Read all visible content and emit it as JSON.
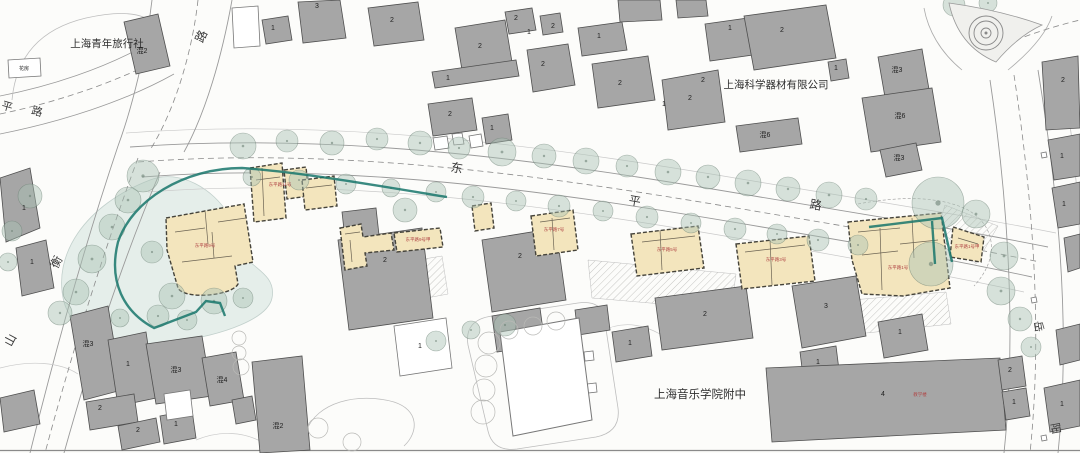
{
  "colors": {
    "background": "#fcfcfa",
    "building_gray": "#a6a6a6",
    "building_gray_stroke": "#4f4f4f",
    "building_white": "#ffffff",
    "heritage_yellow": "#f3e5bd",
    "heritage_stroke": "#45433a",
    "tree_fill": "rgba(168,193,180,0.45)",
    "tree_stroke": "rgba(100,122,110,0.55)",
    "boundary_teal": "#17766b",
    "red_label": "#b04545",
    "road_line": "#9a9a9a",
    "faint_line": "#c4c4c4",
    "garden_tint": "rgba(205,224,218,0.5)"
  },
  "landmark_labels": [
    {
      "t": "上海青年旅行社",
      "x": 107,
      "y": 47,
      "s": 10.5
    },
    {
      "t": "上海科学器材有限公司",
      "x": 776,
      "y": 88,
      "s": 10.5
    },
    {
      "t": "上海音乐学院附中",
      "x": 700,
      "y": 398,
      "s": 11.5
    }
  ],
  "road_name_chars": [
    {
      "t": "东",
      "x": 456,
      "y": 172,
      "s": 12,
      "r": 10
    },
    {
      "t": "平",
      "x": 634,
      "y": 205,
      "s": 12,
      "r": 10
    },
    {
      "t": "路",
      "x": 815,
      "y": 209,
      "s": 12,
      "r": 10
    },
    {
      "t": "衡",
      "x": 60,
      "y": 264,
      "s": 12,
      "r": -62
    },
    {
      "t": "山",
      "x": 14,
      "y": 342,
      "s": 12,
      "r": -62
    },
    {
      "t": "路",
      "x": 205,
      "y": 38,
      "s": 12,
      "r": -65
    },
    {
      "t": "平",
      "x": 6,
      "y": 110,
      "s": 11,
      "r": 16
    },
    {
      "t": "路",
      "x": 36,
      "y": 115,
      "s": 11,
      "r": 16
    },
    {
      "t": "岳",
      "x": 1035,
      "y": 327,
      "s": 11,
      "r": 80
    },
    {
      "t": "阳",
      "x": 1052,
      "y": 429,
      "s": 11,
      "r": 80
    }
  ],
  "building_numbers": [
    {
      "t": "混2",
      "x": 142,
      "y": 53
    },
    {
      "t": "3",
      "x": 317,
      "y": 8
    },
    {
      "t": "1",
      "x": 273,
      "y": 30
    },
    {
      "t": "2",
      "x": 392,
      "y": 22
    },
    {
      "t": "2",
      "x": 480,
      "y": 48
    },
    {
      "t": "2",
      "x": 516,
      "y": 20
    },
    {
      "t": "1",
      "x": 529,
      "y": 34
    },
    {
      "t": "2",
      "x": 543,
      "y": 66
    },
    {
      "t": "1",
      "x": 448,
      "y": 80
    },
    {
      "t": "1",
      "x": 599,
      "y": 38
    },
    {
      "t": "2",
      "x": 620,
      "y": 85
    },
    {
      "t": "2",
      "x": 690,
      "y": 100
    },
    {
      "t": "1",
      "x": 730,
      "y": 30
    },
    {
      "t": "2",
      "x": 782,
      "y": 32
    },
    {
      "t": "1",
      "x": 836,
      "y": 70
    },
    {
      "t": "混3",
      "x": 897,
      "y": 72
    },
    {
      "t": "混6",
      "x": 900,
      "y": 118
    },
    {
      "t": "混6",
      "x": 765,
      "y": 137
    },
    {
      "t": "混3",
      "x": 899,
      "y": 160
    },
    {
      "t": "2",
      "x": 1063,
      "y": 82
    },
    {
      "t": "1",
      "x": 1062,
      "y": 158
    },
    {
      "t": "1",
      "x": 1064,
      "y": 206
    },
    {
      "t": "1",
      "x": 1062,
      "y": 406
    },
    {
      "t": "2",
      "x": 385,
      "y": 262
    },
    {
      "t": "2",
      "x": 450,
      "y": 116
    },
    {
      "t": "1",
      "x": 492,
      "y": 130
    },
    {
      "t": "2",
      "x": 520,
      "y": 258
    },
    {
      "t": "1",
      "x": 420,
      "y": 348
    },
    {
      "t": "2",
      "x": 705,
      "y": 316
    },
    {
      "t": "1",
      "x": 630,
      "y": 345
    },
    {
      "t": "3",
      "x": 826,
      "y": 308
    },
    {
      "t": "1",
      "x": 818,
      "y": 364
    },
    {
      "t": "1",
      "x": 900,
      "y": 334
    },
    {
      "t": "4",
      "x": 883,
      "y": 396
    },
    {
      "t": "2",
      "x": 1010,
      "y": 372
    },
    {
      "t": "1",
      "x": 1014,
      "y": 404
    },
    {
      "t": "混3",
      "x": 88,
      "y": 346
    },
    {
      "t": "1",
      "x": 128,
      "y": 366
    },
    {
      "t": "混3",
      "x": 176,
      "y": 372
    },
    {
      "t": "混4",
      "x": 222,
      "y": 382
    },
    {
      "t": "2",
      "x": 100,
      "y": 410
    },
    {
      "t": "2",
      "x": 138,
      "y": 432
    },
    {
      "t": "1",
      "x": 176,
      "y": 426
    },
    {
      "t": "混2",
      "x": 278,
      "y": 428
    },
    {
      "t": "1",
      "x": 24,
      "y": 210
    },
    {
      "t": "1",
      "x": 32,
      "y": 264
    },
    {
      "t": "花房",
      "x": 24,
      "y": 70,
      "s": 5
    },
    {
      "t": "2",
      "x": 703,
      "y": 82
    },
    {
      "t": "1",
      "x": 664,
      "y": 106
    },
    {
      "t": "2",
      "x": 553,
      "y": 28
    }
  ],
  "red_labels": [
    {
      "t": "东平路11号",
      "x": 280,
      "y": 186
    },
    {
      "t": "东平路9号",
      "x": 205,
      "y": 247
    },
    {
      "t": "东平路9号甲",
      "x": 418,
      "y": 241
    },
    {
      "t": "东平路7号",
      "x": 554,
      "y": 231
    },
    {
      "t": "东平路5号",
      "x": 667,
      "y": 251
    },
    {
      "t": "东平路3号",
      "x": 776,
      "y": 261
    },
    {
      "t": "东平路1号",
      "x": 898,
      "y": 269
    },
    {
      "t": "东平路1号甲",
      "x": 967,
      "y": 248
    },
    {
      "t": "教学楼",
      "x": 920,
      "y": 396
    }
  ],
  "garden_tints": [
    {
      "d": "M150,180 C85,205 52,255 64,302 C74,338 122,350 172,342 C226,335 268,318 272,298 C276,278 258,270 248,260 C238,248 236,228 228,214 C214,190 180,168 150,180 Z"
    }
  ],
  "site_lines": [
    {
      "d": "M130,147 C350,131 560,163 760,197 C880,217 968,231 1048,247",
      "c": "#9a9a9a",
      "w": 0.9
    },
    {
      "d": "M142,177 C350,161 562,193 762,227 C882,247 958,261 1032,277",
      "c": "#9a9a9a",
      "w": 0.9
    },
    {
      "d": "M126,133 C350,117 565,149 765,183 C885,203 975,217 1056,233",
      "c": "#c9c9c9",
      "w": 0.7
    },
    {
      "d": "M148,192 C352,176 564,208 760,242 C875,262 950,276 1024,292",
      "c": "#c9c9c9",
      "w": 0.7
    },
    {
      "d": "M152,0 C146,52 132,108 118,146",
      "c": "#9a9a9a",
      "w": 0.9
    },
    {
      "d": "M232,0 C222,56 206,112 184,152",
      "c": "#9a9a9a",
      "w": 0.9
    },
    {
      "d": "M118,146 C88,235 58,340 30,453",
      "c": "#9a9a9a",
      "w": 0.9
    },
    {
      "d": "M160,172 C122,262 90,360 64,453",
      "c": "#9a9a9a",
      "w": 0.9
    },
    {
      "d": "M0,96 C52,86 104,68 144,46",
      "c": "#9a9a9a",
      "w": 0.8
    },
    {
      "d": "M0,134 C60,122 124,102 174,74",
      "c": "#9a9a9a",
      "w": 0.8
    },
    {
      "d": "M990,80 C1005,180 1018,320 1004,453",
      "c": "#9a9a9a",
      "w": 0.9
    },
    {
      "d": "M1038,70 C1056,180 1072,320 1058,453",
      "c": "#9a9a9a",
      "w": 0.9
    },
    {
      "d": "M1062,66 C1076,160 1080,220 1080,260",
      "c": "#bdbdbd",
      "w": 0.7
    },
    {
      "d": "M12,100 Q18,34 86,18 Q140,6 156,26",
      "c": "#bdbdbd",
      "w": 0.8
    },
    {
      "d": "M468,345 Q464,320 492,316 L578,303 Q600,300 604,316 L618,408 Q621,432 596,437 L517,449 Q493,452 488,431 Z",
      "c": "#bdbdbd",
      "w": 0.8
    },
    {
      "d": "M306,432 C316,402 358,392 394,402 C419,410 419,432 404,446",
      "c": "#bdbdbd",
      "w": 0.8
    },
    {
      "d": "M916,58 C898,95 896,130 912,160",
      "c": "#c9c9c9",
      "w": 0.7
    },
    {
      "d": "M600,332 C622,320 642,324 660,334",
      "c": "#c9c9c9",
      "w": 0.7
    },
    {
      "d": "M962,70 C940,52 928,30 924,8",
      "c": "#ababab",
      "w": 0.8
    },
    {
      "d": "M1008,70 C1030,52 1046,34 1052,16",
      "c": "#ababab",
      "w": 0.8
    },
    {
      "d": "M0,368 C30,360 60,362 78,374",
      "c": "#c9c9c9",
      "w": 0.7
    },
    {
      "d": "M196,440 C220,430 244,432 262,442",
      "c": "#c9c9c9",
      "w": 0.7
    },
    {
      "d": "M0,450.5 L1080,450.5",
      "c": "#8a8a8a",
      "w": 1.2
    }
  ],
  "dashed_lines": [
    {
      "d": "M138,162 C350,146 560,178 760,212 C880,232 962,246 1040,262",
      "c": "#8a8a8a",
      "w": 0.8,
      "p": "6,4"
    },
    {
      "d": "M138,158 C104,250 72,352 45,453",
      "c": "#8a8a8a",
      "w": 0.8,
      "p": "6,4"
    },
    {
      "d": "M198,0 C192,54 174,112 150,150",
      "c": "#8a8a8a",
      "w": 0.8,
      "p": "6,4"
    },
    {
      "d": "M0,114 C58,102 116,82 162,58",
      "c": "#8a8a8a",
      "w": 0.8,
      "p": "6,4"
    },
    {
      "d": "M1014,75 C1030,180 1044,320 1030,453",
      "c": "#8a8a8a",
      "w": 0.8,
      "p": "6,4"
    },
    {
      "d": "M1006,44 C1030,34 1055,26 1080,20",
      "c": "#8a8a8a",
      "w": 0.8,
      "p": "6,4"
    },
    {
      "d": "M858,204 C900,196 940,196 968,210 C996,226 1000,258 974,286",
      "c": "#9a9a9a",
      "w": 0.6,
      "p": "3,2"
    }
  ],
  "island": {
    "d": "M949,3 Q958,46 996,62 Q1018,36 1042,25 Q1000,10 949,3 Z"
  },
  "roundabout": {
    "cx": 986,
    "cy": 33,
    "radii": [
      17,
      12,
      5
    ]
  },
  "hatch_areas": [
    {
      "pts": "346,272 442,256 448,294 352,312"
    },
    {
      "pts": "588,260 736,274 731,310 592,298"
    },
    {
      "pts": "852,300 946,292 951,324 857,334"
    },
    {
      "pts": "945,205 998,226 976,264 938,228"
    }
  ],
  "gray_buildings": [
    {
      "pts": "124,22 158,14 170,66 136,74"
    },
    {
      "pts": "298,2 340,0 346,38 303,43"
    },
    {
      "pts": "262,20 288,16 292,40 266,44"
    },
    {
      "pts": "368,8 418,2 424,40 374,46"
    },
    {
      "pts": "455,28 505,20 512,62 462,70"
    },
    {
      "pts": "505,12 532,8 536,30 509,34"
    },
    {
      "pts": "540,16 560,13 563,32 543,35"
    },
    {
      "pts": "527,50 568,44 575,85 533,92"
    },
    {
      "pts": "432,72 516,60 519,76 435,88"
    },
    {
      "pts": "578,28 622,22 627,50 582,56"
    },
    {
      "pts": "592,64 648,56 655,100 598,108"
    },
    {
      "pts": "662,80 718,70 725,122 668,130"
    },
    {
      "pts": "705,24 755,17 760,54 710,61"
    },
    {
      "pts": "744,16 826,5 836,58 754,70"
    },
    {
      "pts": "828,62 846,59 849,78 831,81"
    },
    {
      "pts": "878,57 922,49 930,95 886,103"
    },
    {
      "pts": "862,98 932,88 941,142 871,152"
    },
    {
      "pts": "880,150 916,143 922,170 886,177"
    },
    {
      "pts": "736,126 798,118 802,144 740,152"
    },
    {
      "pts": "1042,62 1078,56 1080,128 1046,130"
    },
    {
      "pts": "1048,140 1080,134 1080,176 1054,180"
    },
    {
      "pts": "1052,188 1080,182 1080,224 1058,228"
    },
    {
      "pts": "1064,238 1080,234 1080,268 1068,272"
    },
    {
      "pts": "1044,388 1080,380 1080,426 1050,432"
    },
    {
      "pts": "1056,330 1080,324 1080,360 1060,365"
    },
    {
      "pts": "618,0 660,0 662,20 620,22"
    },
    {
      "pts": "676,0 706,0 708,16 678,18"
    },
    {
      "pts": "428,104 472,98 477,130 433,136"
    },
    {
      "pts": "482,118 508,114 512,140 486,144"
    },
    {
      "pts": "338,240 422,228 433,318 349,330"
    },
    {
      "pts": "482,240 556,228 566,300 492,312"
    },
    {
      "pts": "492,316 540,308 545,345 497,352"
    },
    {
      "pts": "575,310 607,305 610,330 578,335"
    },
    {
      "pts": "655,298 746,286 753,338 662,350"
    },
    {
      "pts": "612,332 648,326 652,356 616,362"
    },
    {
      "pts": "792,286 856,276 866,336 802,348"
    },
    {
      "pts": "800,352 836,346 840,378 804,384"
    },
    {
      "pts": "878,322 922,314 928,350 884,358"
    },
    {
      "pts": "766,368 1000,358 1006,430 772,442"
    },
    {
      "pts": "998,360 1022,356 1026,386 1002,390"
    },
    {
      "pts": "1002,392 1026,388 1030,416 1006,420"
    },
    {
      "pts": "70,316 108,306 122,390 84,400"
    },
    {
      "pts": "108,340 146,332 156,398 118,406"
    },
    {
      "pts": "146,344 202,336 212,396 156,404"
    },
    {
      "pts": "202,358 236,352 244,400 210,406"
    },
    {
      "pts": "86,402 134,394 138,422 90,430"
    },
    {
      "pts": "118,426 156,418 160,442 122,450"
    },
    {
      "pts": "160,416 192,410 196,438 164,444"
    },
    {
      "pts": "252,362 302,356 310,450 260,453"
    },
    {
      "pts": "232,400 252,396 256,420 236,424"
    },
    {
      "pts": "0,398 34,390 40,424 4,432"
    },
    {
      "pts": "0,178 30,168 40,228 6,242"
    },
    {
      "pts": "16,248 46,240 54,288 22,296"
    },
    {
      "pts": "342,212 376,208 380,244 346,248"
    }
  ],
  "white_buildings": [
    {
      "pts": "394,326 446,318 452,368 400,376"
    },
    {
      "pts": "8,60 40,58 41,76 9,78"
    },
    {
      "pts": "433,138 447,136 449,148 435,150"
    },
    {
      "pts": "452,134 462,133 464,144 454,145"
    },
    {
      "pts": "469,136 481,134 483,146 471,148"
    },
    {
      "pts": "584,352 593,351 594,360 585,361"
    },
    {
      "pts": "587,384 596,383 597,392 588,393"
    },
    {
      "pts": "1041,153 1046,152 1047,157 1042,158"
    },
    {
      "pts": "1031,298 1036,297 1037,302 1032,303"
    },
    {
      "pts": "1041,436 1046,435 1047,440 1042,441"
    },
    {
      "pts": "232,8 258,6 260,46 234,48"
    },
    {
      "pts": "164,394 190,390 193,416 167,420"
    }
  ],
  "field": {
    "pts": "500,332 579,318 592,420 513,436"
  },
  "yellow_buildings": [
    {
      "d": "M166,218 L244,204 L253,262 L235,266 L238,284 C232,296 184,300 178,288 L167,250 Z"
    },
    {
      "d": "M250,168 L282,163 L286,218 L254,222 Z"
    },
    {
      "d": "M284,170 L306,167 L309,196 L287,199 Z"
    },
    {
      "d": "M302,180 L334,176 L337,206 L305,210 Z"
    },
    {
      "d": "M340,228 L361,224 L363,237 L391,233 L394,250 L365,253 L367,266 L345,270 Z"
    },
    {
      "d": "M394,233 L440,228 L443,247 L397,252 Z"
    },
    {
      "d": "M472,206 L491,203 L494,228 L475,231 Z"
    },
    {
      "d": "M531,216 L573,210 L578,250 L536,256 Z"
    },
    {
      "d": "M631,234 L698,226 L704,268 L637,276 Z"
    },
    {
      "d": "M736,244 L809,236 L815,281 L742,289 Z"
    },
    {
      "d": "M848,222 L941,213 L950,288 L903,296 L862,294 L852,260 Z"
    },
    {
      "d": "M953,227 L984,237 L981,262 L950,257 Z"
    }
  ],
  "plan_lines": [
    {
      "d": "M175,232 L205,228"
    },
    {
      "d": "M205,210 L208,244"
    },
    {
      "d": "M218,222 L246,218"
    },
    {
      "d": "M182,262 L232,256"
    },
    {
      "d": "M212,232 L214,258"
    },
    {
      "d": "M256,180 L280,177"
    },
    {
      "d": "M262,168 L264,216"
    },
    {
      "d": "M306,188 L332,185"
    },
    {
      "d": "M345,234 L360,232"
    },
    {
      "d": "M350,240 L352,262"
    },
    {
      "d": "M540,222 L570,218"
    },
    {
      "d": "M552,218 L554,250"
    },
    {
      "d": "M642,242 L695,236"
    },
    {
      "d": "M660,230 L662,270"
    },
    {
      "d": "M745,252 L805,245"
    },
    {
      "d": "M770,240 L772,285"
    },
    {
      "d": "M858,232 L900,228"
    },
    {
      "d": "M880,228 L882,290"
    },
    {
      "d": "M900,244 L938,240"
    },
    {
      "d": "M912,218 L914,258"
    },
    {
      "d": "M862,255 L898,251"
    },
    {
      "d": "M958,238 L978,244"
    }
  ],
  "teal_boundary": [
    {
      "d": "M447,197 C380,186 300,172 242,168 C184,168 132,200 118,242 C108,282 124,312 154,328 L196,312 L206,301 L220,303 L225,316"
    },
    {
      "d": "M869,227 L942,218 L952,262"
    },
    {
      "d": "M932,221 L935,264"
    }
  ],
  "trees_filled": [
    [
      243,
      146,
      13
    ],
    [
      287,
      141,
      11
    ],
    [
      332,
      143,
      12
    ],
    [
      377,
      139,
      11
    ],
    [
      420,
      143,
      12
    ],
    [
      459,
      148,
      11
    ],
    [
      502,
      152,
      14
    ],
    [
      544,
      156,
      12
    ],
    [
      586,
      161,
      13
    ],
    [
      627,
      166,
      11
    ],
    [
      668,
      172,
      13
    ],
    [
      708,
      177,
      12
    ],
    [
      748,
      183,
      13
    ],
    [
      788,
      189,
      12
    ],
    [
      829,
      195,
      13
    ],
    [
      866,
      199,
      11
    ],
    [
      938,
      203,
      26
    ],
    [
      976,
      214,
      14
    ],
    [
      252,
      177,
      9
    ],
    [
      299,
      180,
      10
    ],
    [
      346,
      184,
      10
    ],
    [
      391,
      188,
      9
    ],
    [
      436,
      192,
      10
    ],
    [
      473,
      197,
      11
    ],
    [
      516,
      201,
      10
    ],
    [
      559,
      206,
      11
    ],
    [
      603,
      211,
      10
    ],
    [
      647,
      217,
      11
    ],
    [
      691,
      223,
      10
    ],
    [
      735,
      229,
      11
    ],
    [
      777,
      234,
      10
    ],
    [
      818,
      240,
      11
    ],
    [
      858,
      245,
      10
    ],
    [
      143,
      176,
      16
    ],
    [
      128,
      200,
      13
    ],
    [
      112,
      227,
      13
    ],
    [
      92,
      259,
      14
    ],
    [
      76,
      292,
      13
    ],
    [
      60,
      313,
      12
    ],
    [
      30,
      196,
      12
    ],
    [
      12,
      231,
      10
    ],
    [
      8,
      262,
      9
    ],
    [
      152,
      252,
      11
    ],
    [
      172,
      296,
      13
    ],
    [
      214,
      301,
      13
    ],
    [
      243,
      298,
      10
    ],
    [
      158,
      316,
      11
    ],
    [
      187,
      320,
      10
    ],
    [
      120,
      318,
      9
    ],
    [
      931,
      264,
      22
    ],
    [
      1004,
      256,
      14
    ],
    [
      1001,
      291,
      14
    ],
    [
      1020,
      319,
      12
    ],
    [
      1031,
      347,
      10
    ],
    [
      954,
      5,
      11
    ],
    [
      988,
      3,
      9
    ],
    [
      405,
      210,
      12
    ],
    [
      505,
      325,
      11
    ],
    [
      471,
      330,
      9
    ],
    [
      436,
      341,
      10
    ]
  ],
  "trees_pale": [
    [
      489,
      343,
      11
    ],
    [
      486,
      366,
      11
    ],
    [
      484,
      390,
      11
    ],
    [
      483,
      412,
      12
    ],
    [
      509,
      330,
      9
    ],
    [
      533,
      326,
      9
    ],
    [
      556,
      321,
      9
    ],
    [
      239,
      338,
      7
    ],
    [
      239,
      353,
      7
    ],
    [
      241,
      367,
      8
    ],
    [
      318,
      428,
      10
    ],
    [
      352,
      442,
      9
    ]
  ]
}
